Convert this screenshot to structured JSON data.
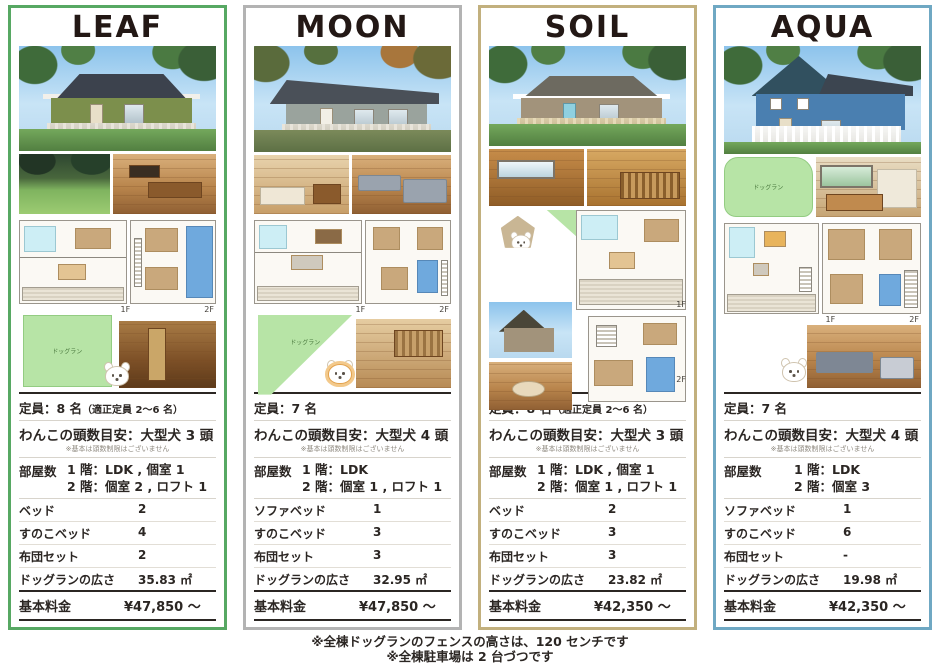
{
  "cards": [
    {
      "name": "LEAF",
      "accent": "#57a863",
      "capacity": "定員：8 名",
      "capacity_note": "（適正定員 2〜6 名）",
      "dogs": "わんこの頭数目安：大型犬 3 頭",
      "dogs_note": "※基本は頭数制限はございません",
      "rooms_label": "部屋数",
      "rooms_1f": "1 階：LDK , 個室 1",
      "rooms_2f": "2 階：個室 2 , ロフト 1",
      "rows": [
        {
          "label": "ベッド",
          "value": "2"
        },
        {
          "label": "すのこベッド",
          "value": "4"
        },
        {
          "label": "布団セット",
          "value": "2"
        },
        {
          "label": "ドッグランの広さ",
          "value": "35.83 ㎡"
        }
      ],
      "price_label": "基本料金",
      "price": "¥47,850 〜",
      "floor1": "1F",
      "floor2": "2F",
      "dogrun_label": "ドッグラン"
    },
    {
      "name": "MOON",
      "accent": "#b3b3b3",
      "capacity": "定員：7 名",
      "capacity_note": "",
      "dogs": "わんこの頭数目安：大型犬 4 頭",
      "dogs_note": "※基本は頭数制限はございません",
      "rooms_label": "部屋数",
      "rooms_1f": "1 階：LDK",
      "rooms_2f": "2 階：個室 1 , ロフト 1",
      "rows": [
        {
          "label": "ソファベッド",
          "value": "1"
        },
        {
          "label": "すのこベッド",
          "value": "3"
        },
        {
          "label": "布団セット",
          "value": "3"
        },
        {
          "label": "ドッグランの広さ",
          "value": "32.95 ㎡"
        }
      ],
      "price_label": "基本料金",
      "price": "¥47,850 〜",
      "floor1": "1F",
      "floor2": "2F",
      "dogrun_label": "ドッグラン"
    },
    {
      "name": "SOIL",
      "accent": "#c2b07e",
      "capacity": "定員：8 名",
      "capacity_note": "（適正定員 2〜6 名）",
      "dogs": "わんこの頭数目安：大型犬 3 頭",
      "dogs_note": "※基本は頭数制限はございません",
      "rooms_label": "部屋数",
      "rooms_1f": "1 階：LDK , 個室 1",
      "rooms_2f": "2 階：個室 1 , ロフト 1",
      "rows": [
        {
          "label": "ベッド",
          "value": "2"
        },
        {
          "label": "すのこベッド",
          "value": "3"
        },
        {
          "label": "布団セット",
          "value": "3"
        },
        {
          "label": "ドッグランの広さ",
          "value": "23.82 ㎡"
        }
      ],
      "price_label": "基本料金",
      "price": "¥42,350 〜",
      "floor1": "1F",
      "floor2": "2F",
      "dogrun_label": "ドッグラン"
    },
    {
      "name": "AQUA",
      "accent": "#6fa8c3",
      "capacity": "定員：7 名",
      "capacity_note": "",
      "dogs": "わんこの頭数目安：大型犬 4 頭",
      "dogs_note": "※基本は頭数制限はございません",
      "rooms_label": "部屋数",
      "rooms_1f": "1 階：LDK",
      "rooms_2f": "2 階：個室 3",
      "rows": [
        {
          "label": "ソファベッド",
          "value": "1"
        },
        {
          "label": "すのこベッド",
          "value": "6"
        },
        {
          "label": "布団セット",
          "value": "-"
        },
        {
          "label": "ドッグランの広さ",
          "value": "19.98 ㎡"
        }
      ],
      "price_label": "基本料金",
      "price": "¥42,350 〜",
      "floor1": "1F",
      "floor2": "2F",
      "dogrun_label": "ドッグラン"
    }
  ],
  "footer": {
    "line1": "※全棟ドッグランのフェンスの高さは、120 センチです",
    "line2": "※全棟駐車場は 2 台づつです"
  }
}
